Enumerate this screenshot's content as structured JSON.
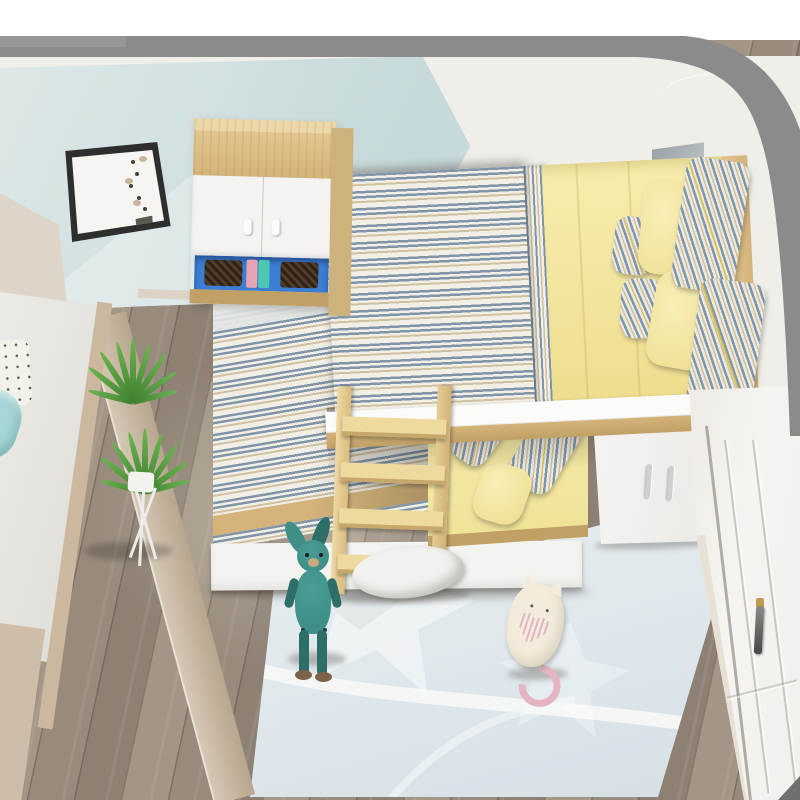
{
  "scene": {
    "description": "Top-down 3D render of a children's bedroom: L-shaped loft bunk bed set with blue-striped and yellow bedding, wood-and-white bookcase with blue open shelf, white under-bed wardrobe, wooden ladder, potted plant on white stand, light-blue rug with teal bunny and cream cat plush toys, gray-brown plank floor, framed wall art, white paneled wardrobe door, gray wall-top border.",
    "brand_mark": {
      "shape": "double-slash-with-dashes",
      "color": "#2a7fd4"
    },
    "objects": [
      "wall-art-frame",
      "bookcase",
      "storage-shelf",
      "loft-bed",
      "striped-duvet",
      "yellow-sheet",
      "striped-pillows",
      "yellow-pillows",
      "safety-rail",
      "brand-logo",
      "lower-bed-left",
      "lower-bed-right",
      "drawer-base",
      "wooden-ladder",
      "under-bed-cabinet",
      "wardrobe-door",
      "door-handle",
      "area-rug",
      "bunny-plush",
      "cat-plush",
      "potted-plant",
      "plant-stand",
      "side-bed",
      "polka-dot-pillow",
      "teal-blanket",
      "wood-floor",
      "wall-top-border"
    ],
    "palette": {
      "frame_gray": "#8b8b8b",
      "frame_light": "#969696",
      "frame_dark": "#6f6f6f",
      "wall_white": "#efeee9",
      "wall_cyan1": "#dde8e8",
      "wall_cyan2": "#c7d9da",
      "wall_shadow": "#98a1a6",
      "floor1": "#a39686",
      "floor2": "#8e8174",
      "wood1": "#e3c690",
      "wood2": "#d4b47b",
      "wood3": "#c1a065",
      "furn_white": "#f4f3f0",
      "stripe_blue": "#8095a8",
      "stripe_tan": "#cfc0a0",
      "stripe_bg": "#f2efe7",
      "yellow1": "#f6ecac",
      "yellow2": "#eedd8d",
      "piping": "#d9c255",
      "shelf_blue": "#3c7ed4",
      "basket": "#523d2a",
      "book_pink": "#e8a4b4",
      "book_teal": "#4cc8b2",
      "rug1": "#e9eef0",
      "rug2": "#d4dfe5",
      "rug_white": "#f7f8f8",
      "bunny": "#3f8e88",
      "bunny_dark": "#2e6e69",
      "muzzle": "#c9a87c",
      "foot_brown": "#7d6148",
      "cat_cream": "#f3ecdc",
      "cat_pink": "#e5b4c2",
      "door_white": "#f2f0ec",
      "handle_dark": "#46464a",
      "handle_gold": "#c09a4e",
      "logo_blue": "#2a7fd4",
      "plant1": "#6cb552",
      "plant2": "#3f8030",
      "blanket_teal": "#a6d6d6",
      "drawer_white": "#f3f3f0",
      "base_tan": "#cdbda9",
      "band1": "#d6c9b6",
      "band2": "#b7a68f",
      "headboard_beige": "#dcd5c8",
      "mattress_white": "#edece8"
    }
  }
}
